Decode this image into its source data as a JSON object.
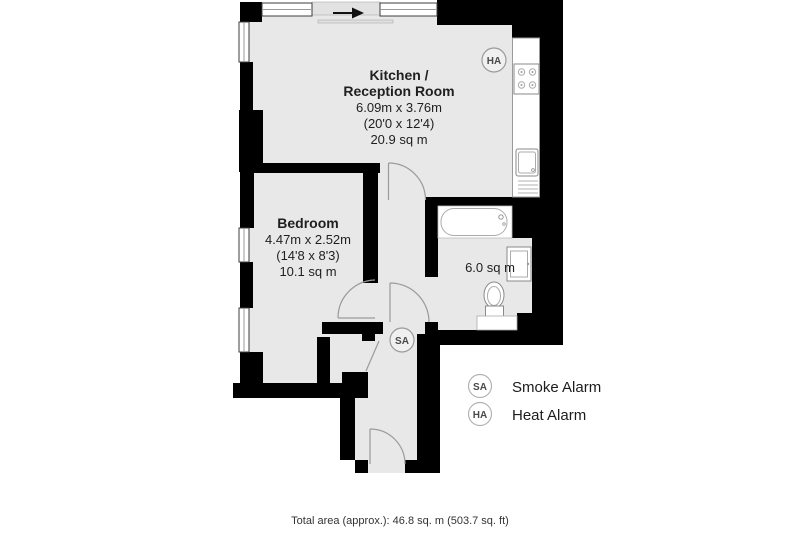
{
  "colors": {
    "floor": "#e8e8e8",
    "wall": "#000000",
    "fixture_border": "#8a8a8a",
    "door_arc": "#9a9a9a",
    "text": "#1f1f1f"
  },
  "rooms": {
    "kitchen": {
      "name_line1": "Kitchen /",
      "name_line2": "Reception Room",
      "dim_metric": "6.09m x 3.76m",
      "dim_imperial": "(20'0 x 12'4)",
      "area": "20.9 sq m"
    },
    "bedroom": {
      "name": "Bedroom",
      "dim_metric": "4.47m x 2.52m",
      "dim_imperial": "(14'8 x 8'3)",
      "area": "10.1 sq m"
    },
    "bathroom": {
      "area": "6.0 sq m"
    }
  },
  "markers": {
    "smoke_code": "SA",
    "heat_code": "HA"
  },
  "legend": {
    "smoke": {
      "code": "SA",
      "label": "Smoke Alarm"
    },
    "heat": {
      "code": "HA",
      "label": "Heat Alarm"
    }
  },
  "footer": {
    "total_area": "Total area (approx.): 46.8 sq. m (503.7 sq. ft)"
  }
}
